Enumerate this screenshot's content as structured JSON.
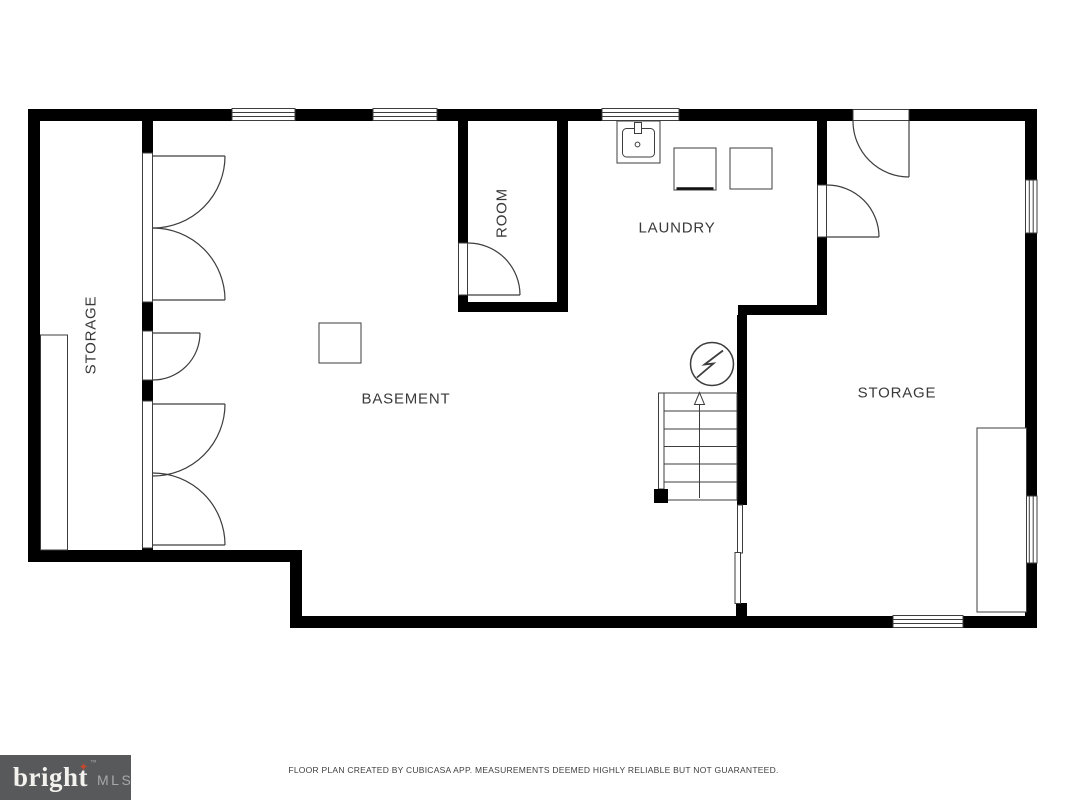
{
  "rooms": {
    "storage_left": {
      "label": "STORAGE"
    },
    "basement": {
      "label": "BASEMENT"
    },
    "room": {
      "label": "ROOM"
    },
    "laundry": {
      "label": "LAUNDRY"
    },
    "storage_right": {
      "label": "STORAGE"
    }
  },
  "symbols": {
    "stairs": "stairs-up-arrow",
    "electrical": "electrical-panel",
    "sink": "laundry-sink",
    "appliance_1": "washer",
    "appliance_2": "dryer",
    "doors": "swing-door-arcs",
    "windows": "wall-windows"
  },
  "footer": {
    "logo": {
      "brand": "bright",
      "mls": "MLS",
      "trademark": "™",
      "star": "✦"
    },
    "disclaimer": "FLOOR PLAN CREATED BY CUBICASA APP. MEASUREMENTS DEEMED HIGHLY RELIABLE BUT NOT GUARANTEED."
  },
  "colors": {
    "wall": "#000000",
    "line": "#3d3d3d",
    "text": "#3a3a3a",
    "background": "#ffffff",
    "logo_bg": "#58595b",
    "logo_text": "#f3f2ee",
    "logo_mls": "#a6a8ab",
    "logo_star": "#c2492f"
  }
}
